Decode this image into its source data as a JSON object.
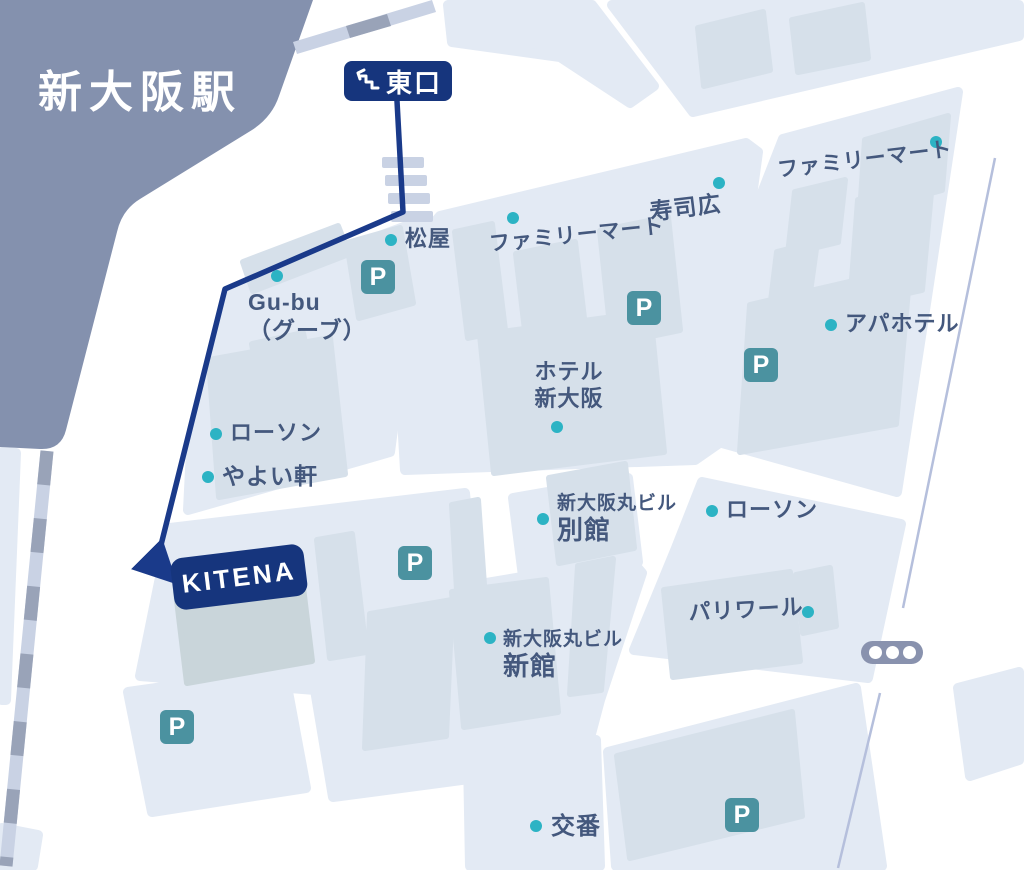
{
  "station": {
    "name": "新大阪駅"
  },
  "exit_badge": {
    "label": "東口"
  },
  "destination_badge": {
    "label": "KITENA"
  },
  "legend": {
    "parking": "P"
  },
  "colors": {
    "route": "#1a3a8a",
    "badge": "#16357d",
    "station_fill": "#8491ae",
    "block": "#e3eaf4",
    "building": "#d6e0ea",
    "kitena_building": "#c9d5da",
    "parking": "#4b92a0",
    "poi_dot": "#2cb3c4",
    "label_text": "#44587d",
    "crosswalk": "#c9d2e4",
    "rail_gray": "#99a3b8",
    "rail_light": "#c9d2e4",
    "centerline": "#b5bfdc",
    "traffic_light": "#8992ae",
    "road": "#ffffff"
  },
  "pois": [
    {
      "id": "matsuya",
      "label": "松屋",
      "size": 22,
      "dot": {
        "x": 391,
        "y": 240
      },
      "text": {
        "x": 405,
        "y": 226
      },
      "tilt": 0
    },
    {
      "id": "familymart-mid",
      "label": "ファミリーマート",
      "size": 21,
      "dot": {
        "x": 513,
        "y": 218
      },
      "text": {
        "x": 488,
        "y": 232
      },
      "tilt": -6
    },
    {
      "id": "sushihiro",
      "label": "寿司広",
      "size": 23,
      "dot": {
        "x": 719,
        "y": 183
      },
      "text": {
        "x": 648,
        "y": 198
      },
      "tilt": -7
    },
    {
      "id": "familymart-ne",
      "label": "ファミリーマート",
      "size": 21,
      "dot": {
        "x": 936,
        "y": 142
      },
      "text": {
        "x": 776,
        "y": 158
      },
      "tilt": -7
    },
    {
      "id": "apahotel",
      "label": "アパホテル",
      "size": 22,
      "dot": {
        "x": 831,
        "y": 325
      },
      "text": {
        "x": 845,
        "y": 311
      },
      "tilt": 0
    },
    {
      "id": "gubu",
      "lines": [
        {
          "text": "Gu-bu",
          "size": 23
        },
        {
          "text": "（グーブ）",
          "size": 23
        }
      ],
      "dot": {
        "x": 277,
        "y": 276
      },
      "text": {
        "x": 248,
        "y": 288
      },
      "tilt": 0
    },
    {
      "id": "lawson-west",
      "label": "ローソン",
      "size": 22,
      "dot": {
        "x": 216,
        "y": 434
      },
      "text": {
        "x": 230,
        "y": 420
      },
      "tilt": 0
    },
    {
      "id": "yayoiken",
      "label": "やよい軒",
      "size": 23,
      "dot": {
        "x": 208,
        "y": 477
      },
      "text": {
        "x": 222,
        "y": 462
      },
      "tilt": 0
    },
    {
      "id": "hotel-shinosaka",
      "lines": [
        {
          "text": "ホテル",
          "size": 22
        },
        {
          "text": "新大阪",
          "size": 22
        }
      ],
      "dot": {
        "x": 557,
        "y": 427
      },
      "text": {
        "x": 527,
        "y": 359
      },
      "tilt": 0,
      "align": "center",
      "width": 84
    },
    {
      "id": "marubiru-bekkan",
      "lines": [
        {
          "text": "新大阪丸ビル",
          "size": 19
        },
        {
          "text": "別館",
          "size": 26
        }
      ],
      "dot": {
        "x": 543,
        "y": 519
      },
      "text": {
        "x": 557,
        "y": 492
      },
      "tilt": 0
    },
    {
      "id": "lawson-east",
      "label": "ローソン",
      "size": 22,
      "dot": {
        "x": 712,
        "y": 511
      },
      "text": {
        "x": 726,
        "y": 497
      },
      "tilt": 0
    },
    {
      "id": "pariwar",
      "label": "パリワール",
      "size": 22,
      "dot": {
        "x": 808,
        "y": 612
      },
      "text": {
        "x": 688,
        "y": 600
      },
      "tilt": -3
    },
    {
      "id": "marubiru-shinkan",
      "lines": [
        {
          "text": "新大阪丸ビル",
          "size": 19
        },
        {
          "text": "新館",
          "size": 26
        }
      ],
      "dot": {
        "x": 490,
        "y": 638
      },
      "text": {
        "x": 503,
        "y": 628
      },
      "tilt": 0
    },
    {
      "id": "koban",
      "label": "交番",
      "size": 24,
      "dot": {
        "x": 536,
        "y": 826
      },
      "text": {
        "x": 551,
        "y": 812
      },
      "tilt": 0
    }
  ],
  "parkings": [
    {
      "x": 361,
      "y": 260
    },
    {
      "x": 627,
      "y": 291
    },
    {
      "x": 744,
      "y": 348
    },
    {
      "x": 398,
      "y": 546
    },
    {
      "x": 160,
      "y": 710
    },
    {
      "x": 725,
      "y": 798
    }
  ],
  "traffic_light": {
    "x": 861,
    "y": 641
  }
}
